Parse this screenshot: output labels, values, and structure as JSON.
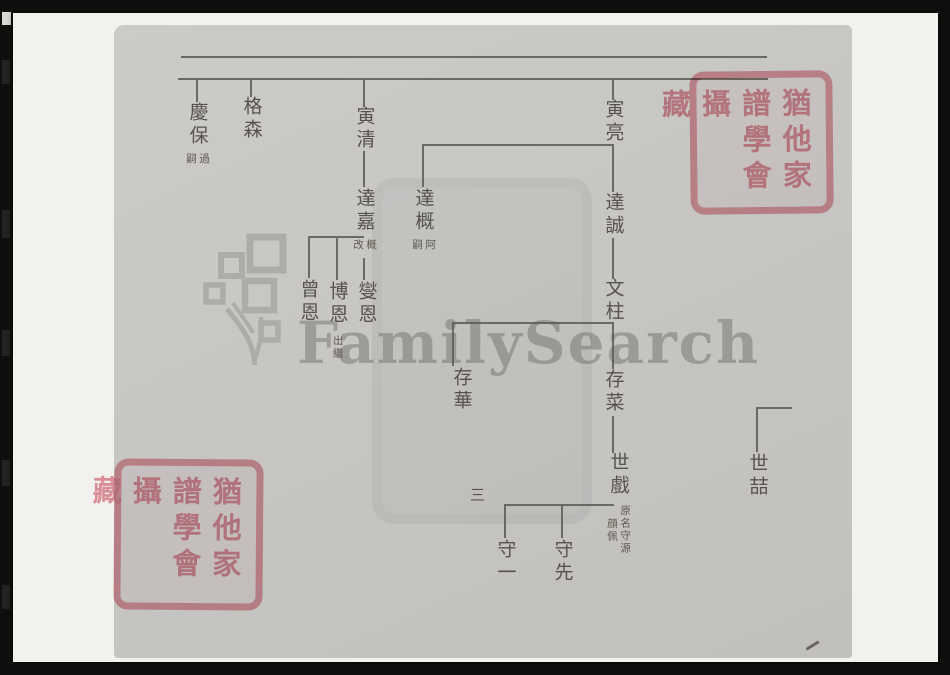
{
  "page": {
    "number_label": "三"
  },
  "watermark": {
    "text": "FamilySearch"
  },
  "seal": {
    "col_right": "猶他家",
    "col_middle": "譜學會",
    "col_left": "攝藏"
  },
  "colors": {
    "film_background": "#0f0f0e",
    "photo_paper": "#f2f1ee",
    "scan_paper": "#c7c6c3",
    "ink": "#56534c",
    "tree_line": "#6b6963",
    "seal_pink": "#e594a0",
    "watermark_gray": "#5f5d58"
  },
  "chart_data": {
    "type": "family-tree-diagram",
    "notes": "Chinese genealogy chart; names written vertically, generations read top to bottom, elder branches to the right",
    "nodes": [
      {
        "id": "qingbao",
        "name": "慶保",
        "annotation": "過嗣",
        "annot_h": 17,
        "x": 197,
        "y": 102
      },
      {
        "id": "gesen",
        "name": "格森",
        "x": 251,
        "y": 96
      },
      {
        "id": "yinqing",
        "name": "寅清",
        "x": 364,
        "y": 106
      },
      {
        "id": "yinliang",
        "name": "寅亮",
        "x": 613,
        "y": 99
      },
      {
        "id": "dagai",
        "name": "達概",
        "annotation": "阿嗣",
        "annot_h": 17,
        "x": 423,
        "y": 188
      },
      {
        "id": "dajia",
        "name": "達嘉",
        "annotation": "概改",
        "annot_h": 17,
        "x": 364,
        "y": 188
      },
      {
        "id": "dacheng",
        "name": "達誠",
        "x": 613,
        "y": 192
      },
      {
        "id": "wenzhu",
        "name": "文柱",
        "x": 613,
        "y": 278
      },
      {
        "id": "cengen",
        "name": "曾恩",
        "x": 308,
        "y": 279
      },
      {
        "id": "boen",
        "name": "博恩",
        "annotation": "出繼",
        "annot_h": 34,
        "x": 337,
        "y": 281
      },
      {
        "id": "xieen",
        "name": "燮恩",
        "x": 366,
        "y": 281
      },
      {
        "id": "cunhua",
        "name": "存華",
        "x": 461,
        "y": 367
      },
      {
        "id": "cunlai",
        "name": "存菜",
        "x": 613,
        "y": 369
      },
      {
        "id": "shixi",
        "name": "世戲",
        "annotation": "原名守源顔佩",
        "annot_h": 58,
        "x": 618,
        "y": 452
      },
      {
        "id": "shouyi",
        "name": "守一",
        "x": 505,
        "y": 539
      },
      {
        "id": "shouxian",
        "name": "守先",
        "x": 562,
        "y": 539
      },
      {
        "id": "shizhe",
        "name": "世喆",
        "x": 757,
        "y": 453
      }
    ],
    "segments": [
      {
        "x": 181,
        "y": 56,
        "w": 586,
        "h": 2
      },
      {
        "x": 178,
        "y": 78,
        "w": 590,
        "h": 2
      },
      {
        "x": 196,
        "y": 79,
        "w": 1.6,
        "h": 23
      },
      {
        "x": 250,
        "y": 79,
        "w": 1.6,
        "h": 18
      },
      {
        "x": 363,
        "y": 79,
        "w": 1.6,
        "h": 28
      },
      {
        "x": 612,
        "y": 79,
        "w": 1.6,
        "h": 21
      },
      {
        "x": 363,
        "y": 151,
        "w": 1.6,
        "h": 36
      },
      {
        "x": 422,
        "y": 144,
        "w": 192,
        "h": 1.6
      },
      {
        "x": 422,
        "y": 144,
        "w": 1.6,
        "h": 43
      },
      {
        "x": 612,
        "y": 144,
        "w": 1.6,
        "h": 48
      },
      {
        "x": 612,
        "y": 238,
        "w": 1.6,
        "h": 41
      },
      {
        "x": 308,
        "y": 236,
        "w": 56,
        "h": 1.6
      },
      {
        "x": 308,
        "y": 236,
        "w": 1.6,
        "h": 42
      },
      {
        "x": 336,
        "y": 236,
        "w": 1.6,
        "h": 44
      },
      {
        "x": 363,
        "y": 258,
        "w": 1.6,
        "h": 22
      },
      {
        "x": 452,
        "y": 322,
        "w": 162,
        "h": 1.6
      },
      {
        "x": 452,
        "y": 322,
        "w": 1.6,
        "h": 44
      },
      {
        "x": 612,
        "y": 324,
        "w": 1.6,
        "h": 45
      },
      {
        "x": 612,
        "y": 416,
        "w": 1.6,
        "h": 37
      },
      {
        "x": 504,
        "y": 504,
        "w": 110,
        "h": 1.6
      },
      {
        "x": 504,
        "y": 504,
        "w": 1.6,
        "h": 34
      },
      {
        "x": 561,
        "y": 504,
        "w": 1.6,
        "h": 34
      },
      {
        "x": 756,
        "y": 407,
        "w": 36,
        "h": 1.6
      },
      {
        "x": 756,
        "y": 407,
        "w": 1.6,
        "h": 45
      }
    ]
  }
}
